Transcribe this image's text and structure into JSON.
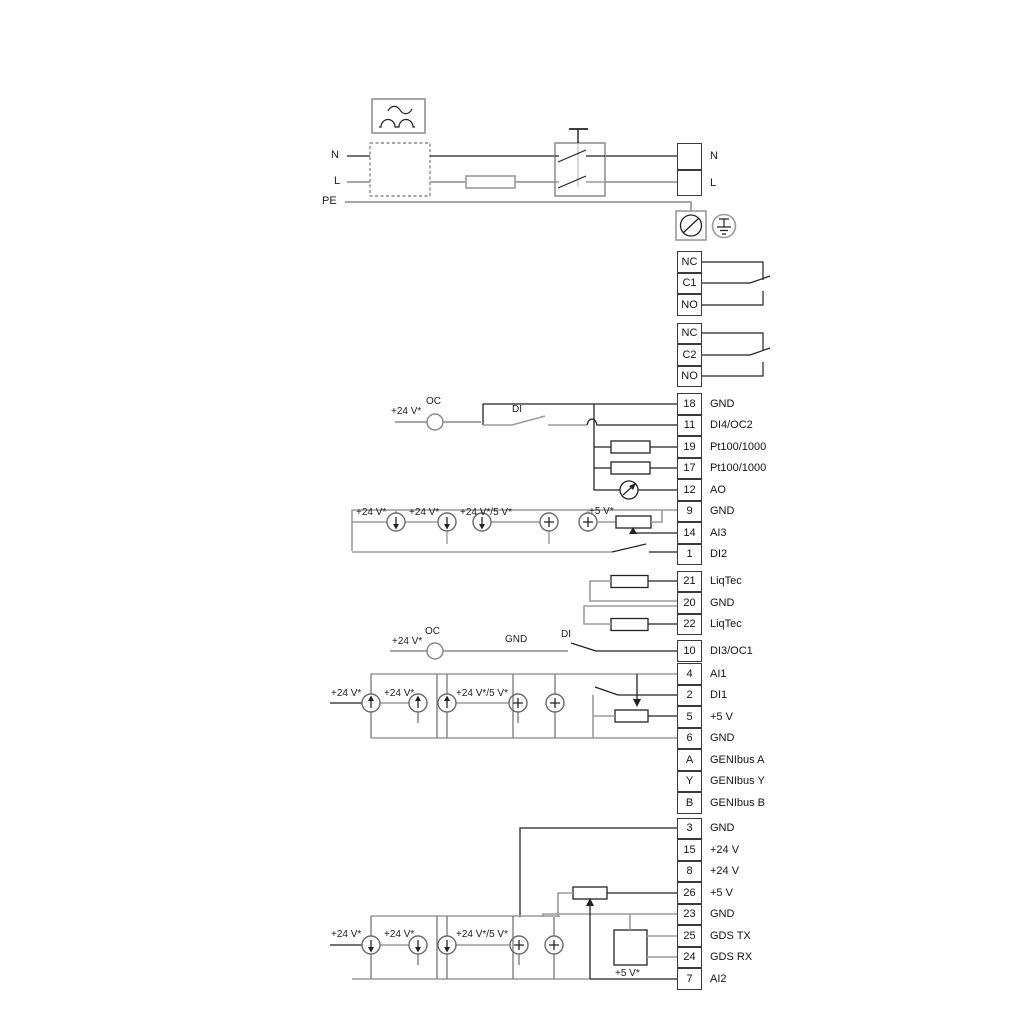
{
  "labels": {
    "n": "N",
    "l": "L",
    "pe": "PE",
    "a_supply": "+24 V*",
    "a_oc": "OC",
    "a_di": "DI",
    "b1": "+24 V*",
    "b2": "+24 V*",
    "b3": "+24 V*/5 V*",
    "b4": "+5 V*",
    "c_supply": "+24 V*",
    "c_oc": "OC",
    "c_gnd": "GND",
    "c_di": "DI",
    "c1": "+24 V*",
    "c2": "+24 V*",
    "c3": "+24 V*/5 V*",
    "d1": "+24 V*",
    "d2": "+24 V*",
    "d3": "+24 V*/5 V*",
    "d4": "+5 V*"
  },
  "terminals": {
    "power_out": [
      {
        "id": "",
        "label": "N"
      },
      {
        "id": "",
        "label": "L"
      }
    ],
    "relay1": [
      {
        "id": "NC",
        "label": ""
      },
      {
        "id": "C1",
        "label": ""
      },
      {
        "id": "NO",
        "label": ""
      }
    ],
    "relay2": [
      {
        "id": "NC",
        "label": ""
      },
      {
        "id": "C2",
        "label": ""
      },
      {
        "id": "NO",
        "label": ""
      }
    ],
    "io1": [
      {
        "id": "18",
        "label": "GND"
      },
      {
        "id": "11",
        "label": "DI4/OC2"
      },
      {
        "id": "19",
        "label": "Pt100/1000"
      },
      {
        "id": "17",
        "label": "Pt100/1000"
      },
      {
        "id": "12",
        "label": "AO"
      },
      {
        "id": "9",
        "label": "GND"
      },
      {
        "id": "14",
        "label": "AI3"
      },
      {
        "id": "1",
        "label": "DI2"
      }
    ],
    "liqtec": [
      {
        "id": "21",
        "label": "LiqTec"
      },
      {
        "id": "20",
        "label": "GND"
      },
      {
        "id": "22",
        "label": "LiqTec"
      }
    ],
    "di3": [
      {
        "id": "10",
        "label": "DI3/OC1"
      }
    ],
    "io2": [
      {
        "id": "4",
        "label": "AI1"
      },
      {
        "id": "2",
        "label": "DI1"
      },
      {
        "id": "5",
        "label": "+5 V"
      },
      {
        "id": "6",
        "label": "GND"
      },
      {
        "id": "A",
        "label": "GENIbus A"
      },
      {
        "id": "Y",
        "label": "GENIbus Y"
      },
      {
        "id": "B",
        "label": "GENIbus B"
      }
    ],
    "io3": [
      {
        "id": "3",
        "label": "GND"
      },
      {
        "id": "15",
        "label": "+24 V"
      },
      {
        "id": "8",
        "label": "+24 V"
      },
      {
        "id": "26",
        "label": "+5 V"
      },
      {
        "id": "23",
        "label": "GND"
      },
      {
        "id": "25",
        "label": "GDS TX"
      },
      {
        "id": "24",
        "label": "GDS RX"
      },
      {
        "id": "7",
        "label": "AI2"
      }
    ]
  },
  "colors": {
    "wire_gray": "#9b9b9b",
    "wire_black": "#222222",
    "box_gray": "#8a8a8a"
  }
}
